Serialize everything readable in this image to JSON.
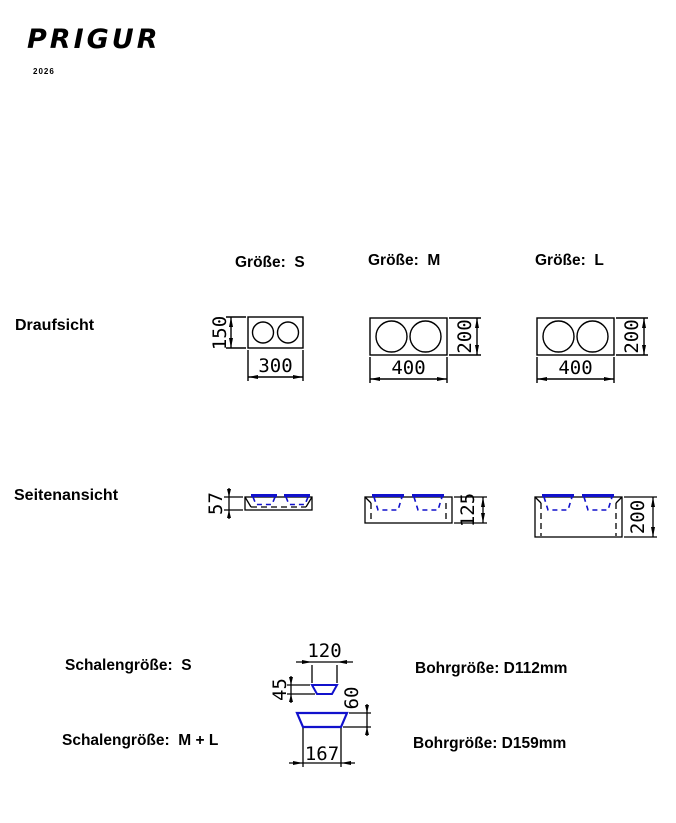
{
  "logo": {
    "title": "PRIGUR",
    "year": "2026"
  },
  "sections": {
    "top_view_label": "Draufsicht",
    "side_view_label": "Seitenansicht"
  },
  "sizes": {
    "s": {
      "label": "Größe:  S"
    },
    "m": {
      "label": "Größe:  M"
    },
    "l": {
      "label": "Größe:  L"
    }
  },
  "dims": {
    "s_top_width": "300",
    "s_top_height": "150",
    "m_top_width": "400",
    "m_top_height": "200",
    "l_top_width": "400",
    "l_top_height": "200",
    "s_side_height": "57",
    "m_side_height": "125",
    "l_side_height": "200"
  },
  "bowls": {
    "s_label": "Schalengröße:  S",
    "ml_label": "Schalengröße:  M + L",
    "s_width": "120",
    "s_depth": "45",
    "ml_width": "167",
    "ml_depth": "60",
    "drill_s": "Bohrgröße: D112mm",
    "drill_ml": "Bohrgröße: D159mm"
  },
  "colors": {
    "line": "#000000",
    "bowl_accent": "#1111cc",
    "background": "#ffffff"
  }
}
